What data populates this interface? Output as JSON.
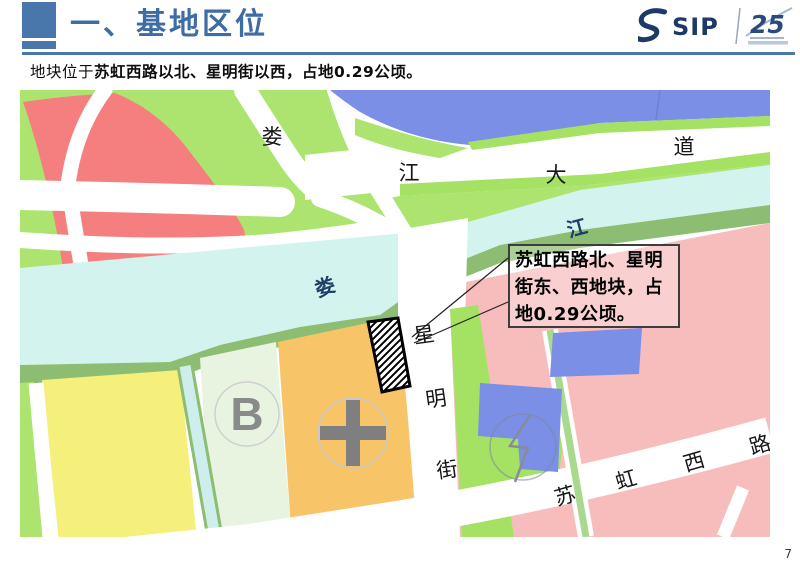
{
  "slide": {
    "title": "一、基地区位",
    "subtitle": {
      "prefix": "地块位于",
      "emphasis": "苏虹西路以北、星明街以西，占地0.29公顷。"
    },
    "page_number": "7",
    "logo": {
      "brand": "SIP",
      "anniversary": "25"
    },
    "accent_color": "#4a77ab"
  },
  "map": {
    "callout": {
      "text": "苏虹西路北、星明街东、西地块，占地0.29公顷。"
    },
    "labels": {
      "avenue": [
        "娄",
        "江",
        "大",
        "道"
      ],
      "river": [
        "娄",
        "江"
      ],
      "street": [
        "星",
        "明",
        "街"
      ],
      "road": [
        "苏",
        "虹",
        "西",
        "路"
      ]
    },
    "marks": {
      "b": "B"
    },
    "colors": {
      "light_green": "#ace46f",
      "bright_green": "#a5e163",
      "river_bank": "#8cbd72",
      "river_water": "#d2f3ee",
      "canal_water": "#cdeeea",
      "yellow_parcel": "#f5ef7c",
      "pale_green_parcel": "#e9f4e0",
      "orange_parcel": "#f7c468",
      "pink_parcel": "#f7bdbd",
      "blue_parcel": "#7b8fe7",
      "red_parcel": "#f57f7f",
      "symbol_gray": "#7f7f7f",
      "river_label": "#1e3f66"
    }
  }
}
